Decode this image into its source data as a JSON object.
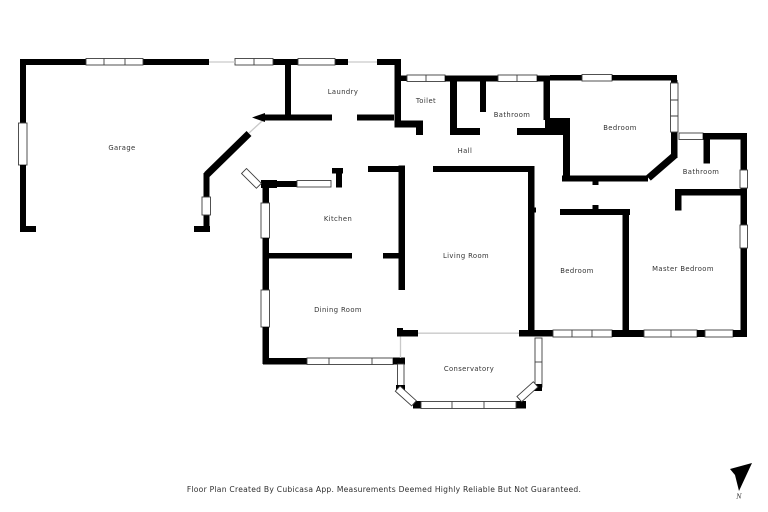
{
  "rooms": {
    "garage": "Garage",
    "laundry": "Laundry",
    "toilet": "Toilet",
    "bathroom_top": "Bathroom",
    "bedroom_top": "Bedroom",
    "hall": "Hall",
    "kitchen": "Kitchen",
    "bathroom_right": "Bathroom",
    "living_room": "Living Room",
    "bedroom_middle": "Bedroom",
    "master_bedroom": "Master Bedroom",
    "dining_room": "Dining Room",
    "conservatory": "Conservatory"
  },
  "footer": {
    "disclaimer": "Floor Plan Created By Cubicasa App. Measurements Deemed Highly Reliable But Not Guaranteed."
  },
  "compass": {
    "north_label": "N"
  },
  "colors": {
    "wall": "#000000",
    "background": "#ffffff",
    "opening_line": "#c9c9c9",
    "label_text": "#333333"
  }
}
